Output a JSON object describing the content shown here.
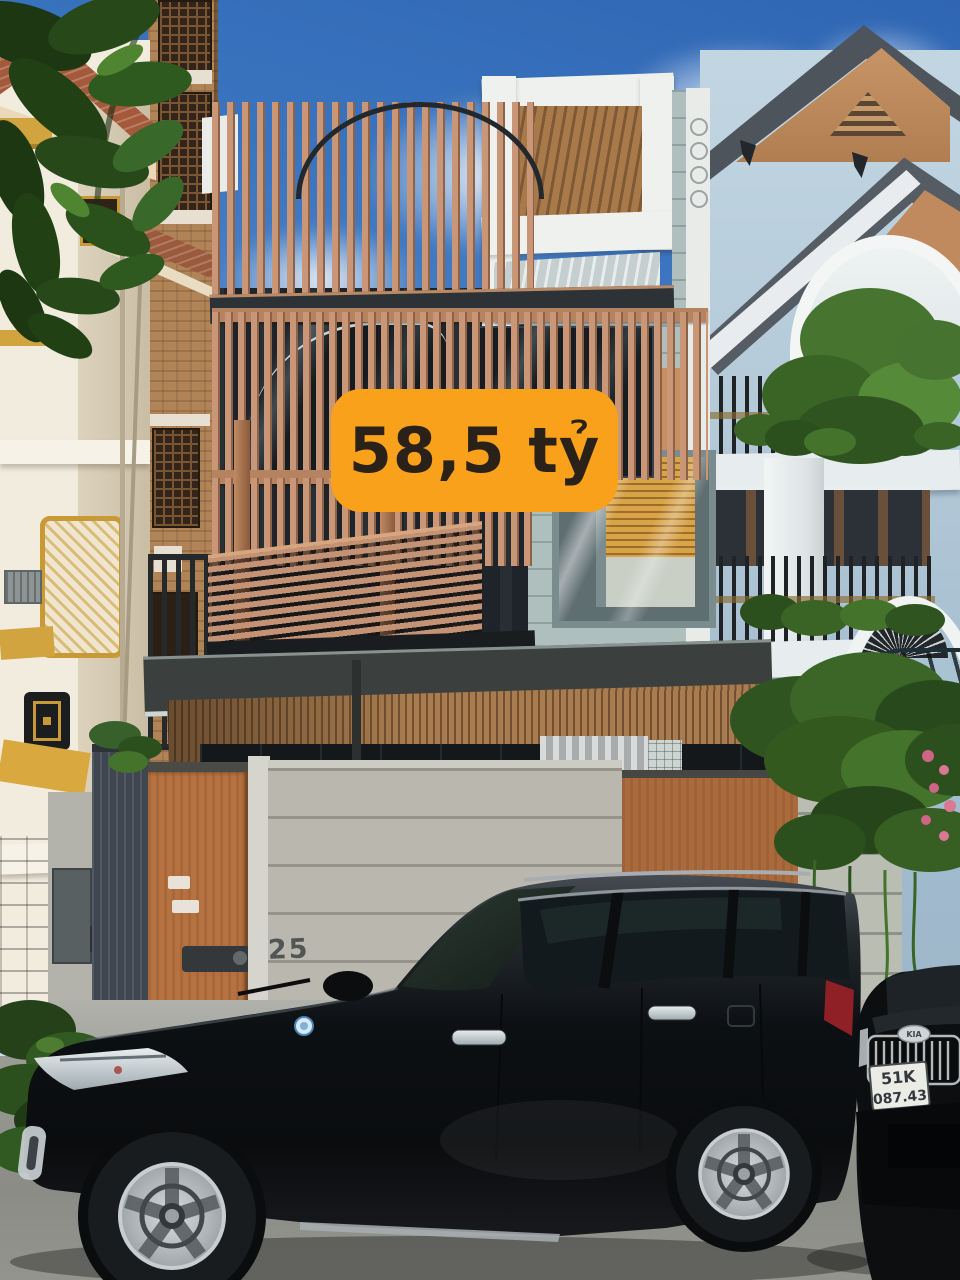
{
  "price_badge": {
    "text": "58,5 tỷ",
    "background": "#F9A11B",
    "text_color": "#2A2219"
  },
  "gate": {
    "house_number": "25"
  },
  "vehicles": {
    "suv": {
      "color": "black",
      "sticker_icon": "registration-sticker-icon"
    },
    "parked_car": {
      "brand": "KIA",
      "plate_line1": "51K",
      "plate_line2": "087.43",
      "plate_bg": "#EBECE6"
    }
  },
  "icons": {
    "cctv": "cctv-camera-icon",
    "floodlight": "floodlight-icon",
    "wall_lantern": "wall-lantern-icon",
    "kia_badge": "kia-badge-icon",
    "registration_sticker": "registration-sticker-icon"
  },
  "colors": {
    "sky_deep": "#3A72BE",
    "sky_pale": "#CFE0F2",
    "cloud": "#F4F8FA",
    "slat_wood": "#C99778",
    "slat_shadow": "#8E6247",
    "glass_dark": "#1E2429",
    "siding_gray": "#AEBFBE",
    "blinds_orange": "#D9A348",
    "terrace_white": "#EEF1EE",
    "soffit_wood": "#A87C4E",
    "villa_wall": "#B3C9D8",
    "villa_roof": "#4F565C",
    "villa_pediment": "#BF8A5F",
    "left_house": "#F2ECDF",
    "gold_trim": "#D2A440",
    "brick": "#B08457",
    "fence_wood": "#B5713F",
    "fence_concrete": "#BAB8AE",
    "stone": "#8D9086",
    "metal_gate": "#3E4650",
    "canopy_steel": "#3B403E",
    "car_body": "#101215",
    "road": "#95968F",
    "leaf_dark": "#1F3A15",
    "leaf_mid": "#2C501D",
    "leaf_light": "#3A6A26",
    "badge_orange": "#F9A11B"
  }
}
